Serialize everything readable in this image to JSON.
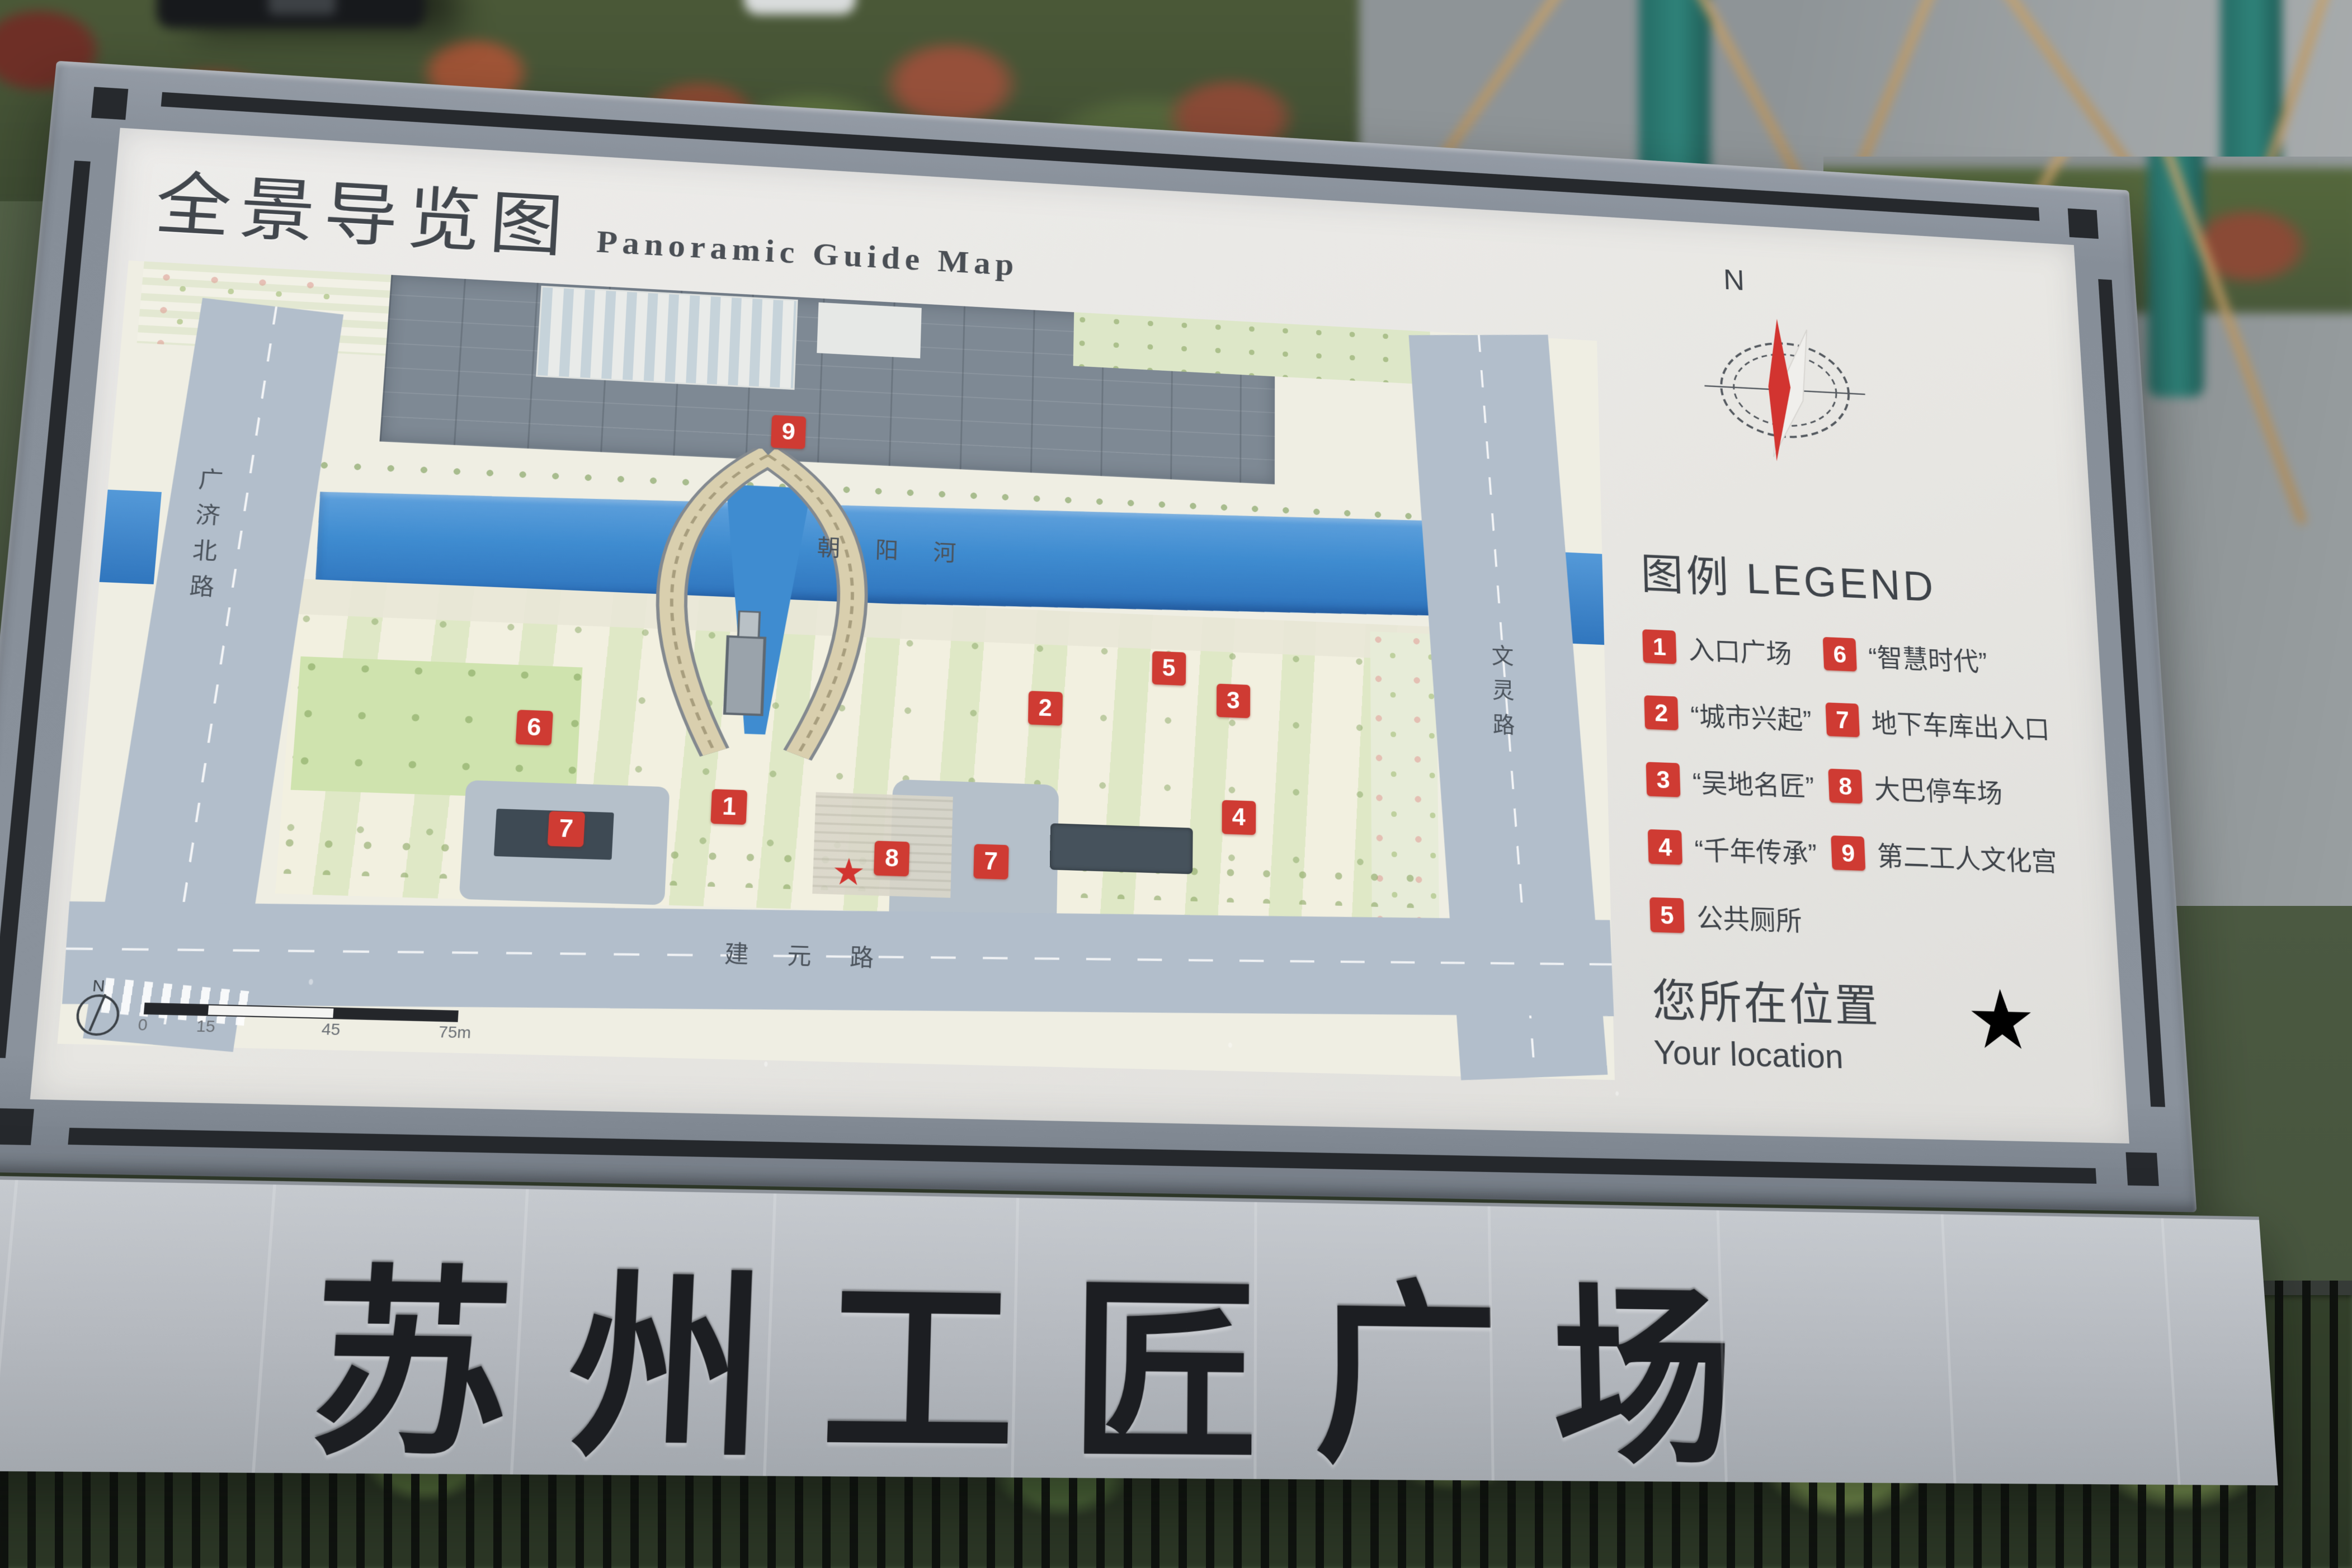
{
  "sign": {
    "title": {
      "zh": "全景导览图",
      "en": "Panoramic Guide Map"
    },
    "board_title": "苏州工匠广场",
    "compass": {
      "n": "N"
    },
    "legend": {
      "heading": "图例 LEGEND",
      "items": [
        {
          "num": "1",
          "label": "入口广场"
        },
        {
          "num": "2",
          "label": "“城市兴起”"
        },
        {
          "num": "3",
          "label": "“吴地名匠”"
        },
        {
          "num": "4",
          "label": "“千年传承”"
        },
        {
          "num": "5",
          "label": "公共厕所"
        },
        {
          "num": "6",
          "label": "“智慧时代”"
        },
        {
          "num": "7",
          "label": "地下车库出入口"
        },
        {
          "num": "8",
          "label": "大巴停车场"
        },
        {
          "num": "9",
          "label": "第二工人文化宫"
        }
      ]
    },
    "location": {
      "zh": "您所在位置",
      "en": "Your location",
      "star": "★"
    },
    "map": {
      "labels": {
        "river": "朝阳河",
        "road_left": "广济北路",
        "road_right": "文灵路",
        "road_bottom": "建元路"
      },
      "scale": {
        "n": "N",
        "ticks": [
          {
            "t": "0",
            "pos": 0
          },
          {
            "t": "15",
            "pos": 20
          },
          {
            "t": "45",
            "pos": 60
          },
          {
            "t": "75m",
            "pos": 100
          }
        ]
      },
      "markers": [
        {
          "num": "9",
          "x": 43.8,
          "y": 18.6
        },
        {
          "num": "5",
          "x": 69.8,
          "y": 48.1
        },
        {
          "num": "3",
          "x": 74.2,
          "y": 52.1
        },
        {
          "num": "2",
          "x": 61.5,
          "y": 54.0
        },
        {
          "num": "6",
          "x": 28.1,
          "y": 59.0
        },
        {
          "num": "4",
          "x": 74.6,
          "y": 67.4
        },
        {
          "num": "1",
          "x": 40.9,
          "y": 68.3
        },
        {
          "num": "7",
          "x": 30.5,
          "y": 71.8
        },
        {
          "num": "8",
          "x": 51.6,
          "y": 74.2
        },
        {
          "num": "7",
          "x": 58.1,
          "y": 74.2
        }
      ],
      "you_are_here": {
        "x": 48.8,
        "y": 76.1,
        "star": "★"
      }
    },
    "colors": {
      "marker_red": "#cf3b33",
      "star_red": "#d23430",
      "river_blue": "#3f8cd0",
      "frame_gray": "#8a929c",
      "board_white": "#e9e8e4",
      "band_gray": "#b7bbc1",
      "building_gray": "#7e8994",
      "road_gray": "#b2becb",
      "ink": "#3f444a"
    }
  }
}
